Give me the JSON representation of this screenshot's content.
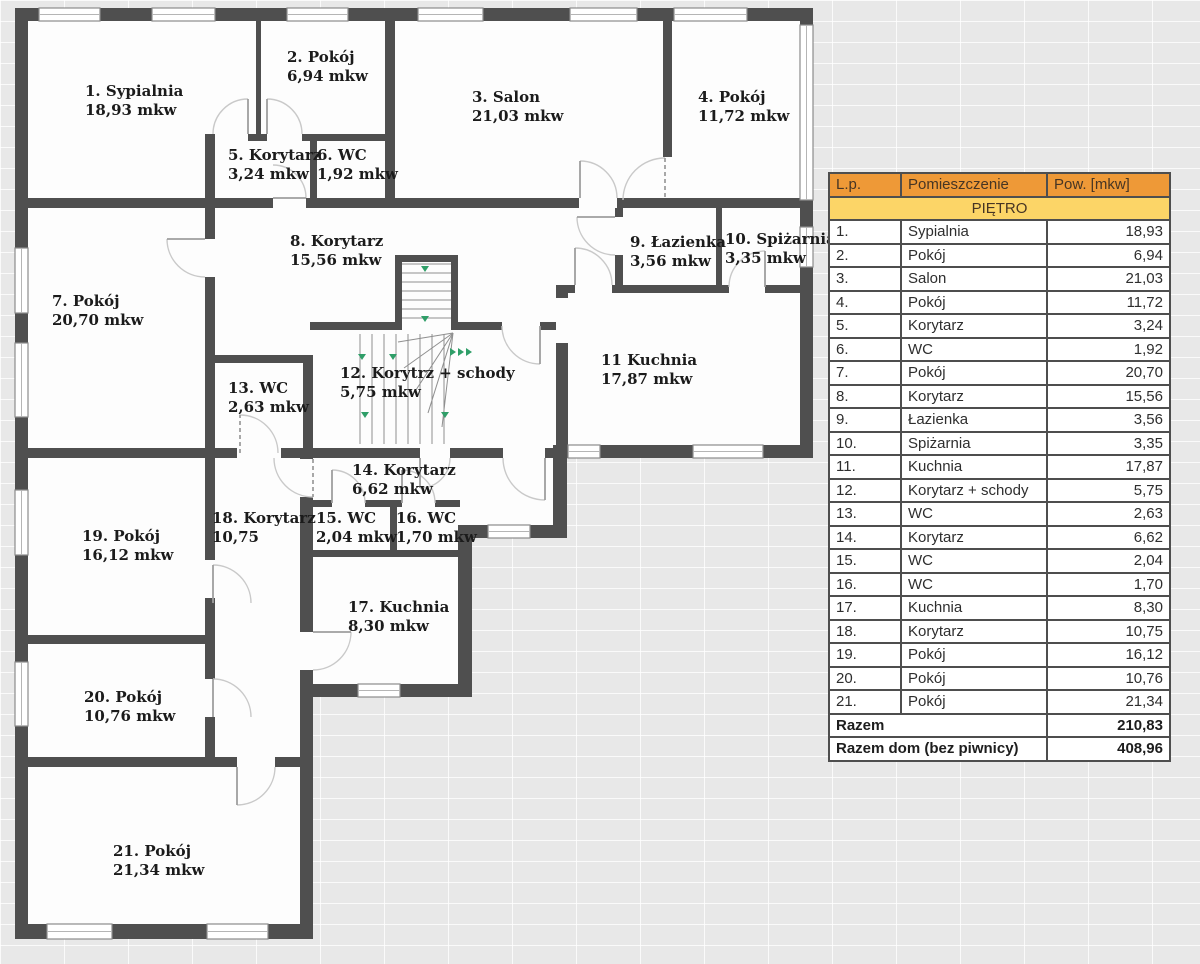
{
  "floorplan": {
    "rooms": [
      {
        "label": "1. Sypialnia",
        "area": "18,93 mkw"
      },
      {
        "label": "2. Pokój",
        "area": "6,94 mkw"
      },
      {
        "label": "3. Salon",
        "area": "21,03 mkw"
      },
      {
        "label": "4. Pokój",
        "area": "11,72 mkw"
      },
      {
        "label": "5. Korytarz",
        "area": "3,24 mkw"
      },
      {
        "label": "6. WC",
        "area": "1,92 mkw"
      },
      {
        "label": "7. Pokój",
        "area": "20,70 mkw"
      },
      {
        "label": "8. Korytarz",
        "area": "15,56 mkw"
      },
      {
        "label": "9. Łazienka",
        "area": "3,56 mkw"
      },
      {
        "label": "10. Spiżarnia",
        "area": "3,35 mkw"
      },
      {
        "label": "11 Kuchnia",
        "area": "17,87 mkw"
      },
      {
        "label": "12. Korytrz + schody",
        "area": "5,75 mkw"
      },
      {
        "label": "13. WC",
        "area": "2,63 mkw"
      },
      {
        "label": "14. Korytarz",
        "area": "6,62 mkw"
      },
      {
        "label": "15. WC",
        "area": "2,04 mkw"
      },
      {
        "label": "16. WC",
        "area": "1,70 mkw"
      },
      {
        "label": "17. Kuchnia",
        "area": "8,30 mkw"
      },
      {
        "label": "18. Korytarz",
        "area": "10,75"
      },
      {
        "label": "19. Pokój",
        "area": "16,12 mkw"
      },
      {
        "label": "20. Pokój",
        "area": "10,76 mkw"
      },
      {
        "label": "21. Pokój",
        "area": "21,34 mkw"
      }
    ]
  },
  "table": {
    "columns": [
      "L.p.",
      "Pomieszczenie",
      "Pow. [mkw]"
    ],
    "section_header": "PIĘTRO",
    "rows": [
      [
        "1.",
        "Sypialnia",
        "18,93"
      ],
      [
        "2.",
        "Pokój",
        "6,94"
      ],
      [
        "3.",
        "Salon",
        "21,03"
      ],
      [
        "4.",
        "Pokój",
        "11,72"
      ],
      [
        "5.",
        "Korytarz",
        "3,24"
      ],
      [
        "6.",
        "WC",
        "1,92"
      ],
      [
        "7.",
        "Pokój",
        "20,70"
      ],
      [
        "8.",
        "Korytarz",
        "15,56"
      ],
      [
        "9.",
        "Łazienka",
        "3,56"
      ],
      [
        "10.",
        "Spiżarnia",
        "3,35"
      ],
      [
        "11.",
        "Kuchnia",
        "17,87"
      ],
      [
        "12.",
        "Korytarz + schody",
        "5,75"
      ],
      [
        "13.",
        "WC",
        "2,63"
      ],
      [
        "14.",
        "Korytarz",
        "6,62"
      ],
      [
        "15.",
        "WC",
        "2,04"
      ],
      [
        "16.",
        "WC",
        "1,70"
      ],
      [
        "17.",
        "Kuchnia",
        "8,30"
      ],
      [
        "18.",
        "Korytarz",
        "10,75"
      ],
      [
        "19.",
        "Pokój",
        "16,12"
      ],
      [
        "20.",
        "Pokój",
        "10,76"
      ],
      [
        "21.",
        "Pokój",
        "21,34"
      ]
    ],
    "totals": [
      {
        "label": "Razem",
        "value": "210,83"
      },
      {
        "label": "Razem dom (bez piwnicy)",
        "value": "408,96"
      }
    ],
    "colors": {
      "header_bg": "#ee9937",
      "section_bg": "#fcd567",
      "wall": "#4f4f4f"
    }
  }
}
